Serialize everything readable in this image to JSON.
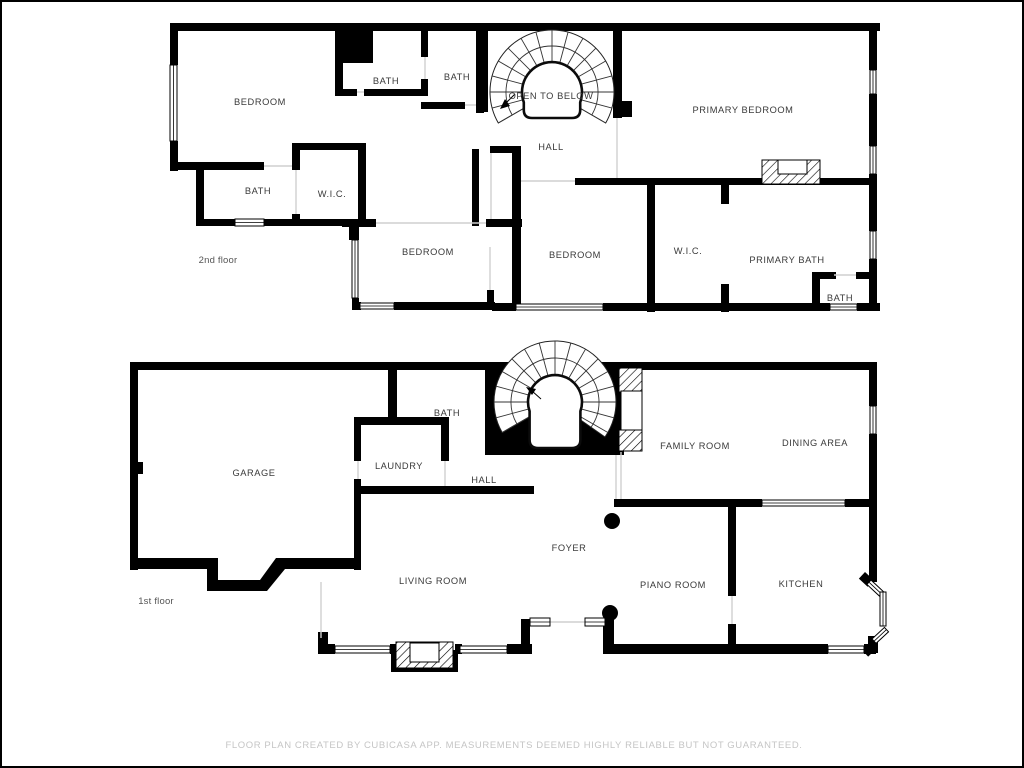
{
  "colors": {
    "background": "#ffffff",
    "wall": "#000000",
    "label": "#3a3a3a",
    "floor_label": "#555555",
    "footer": "#c5c5c5"
  },
  "floors": [
    {
      "label": "2nd floor",
      "rooms": [
        {
          "id": "bedroom-left",
          "label": "BEDROOM"
        },
        {
          "id": "bath-top-1",
          "label": "BATH"
        },
        {
          "id": "bath-top-2",
          "label": "BATH"
        },
        {
          "id": "open-to-below",
          "label": "OPEN TO BELOW"
        },
        {
          "id": "primary-bedroom",
          "label": "PRIMARY BEDROOM"
        },
        {
          "id": "hall",
          "label": "HALL"
        },
        {
          "id": "bath-2",
          "label": "BATH"
        },
        {
          "id": "wic-1",
          "label": "W.I.C."
        },
        {
          "id": "bedroom-middle",
          "label": "BEDROOM"
        },
        {
          "id": "bedroom-right",
          "label": "BEDROOM"
        },
        {
          "id": "wic-2",
          "label": "W.I.C."
        },
        {
          "id": "primary-bath",
          "label": "PRIMARY BATH"
        },
        {
          "id": "bath-3",
          "label": "BATH"
        }
      ]
    },
    {
      "label": "1st floor",
      "rooms": [
        {
          "id": "garage",
          "label": "GARAGE"
        },
        {
          "id": "bath",
          "label": "BATH"
        },
        {
          "id": "laundry",
          "label": "LAUNDRY"
        },
        {
          "id": "hall",
          "label": "HALL"
        },
        {
          "id": "family-room",
          "label": "FAMILY ROOM"
        },
        {
          "id": "dining-area",
          "label": "DINING AREA"
        },
        {
          "id": "foyer",
          "label": "FOYER"
        },
        {
          "id": "living-room",
          "label": "LIVING ROOM"
        },
        {
          "id": "piano-room",
          "label": "PIANO ROOM"
        },
        {
          "id": "kitchen",
          "label": "KITCHEN"
        }
      ]
    }
  ],
  "footer": {
    "text": "FLOOR PLAN CREATED BY CUBICASA APP. MEASUREMENTS DEEMED HIGHLY RELIABLE BUT NOT GUARANTEED."
  }
}
